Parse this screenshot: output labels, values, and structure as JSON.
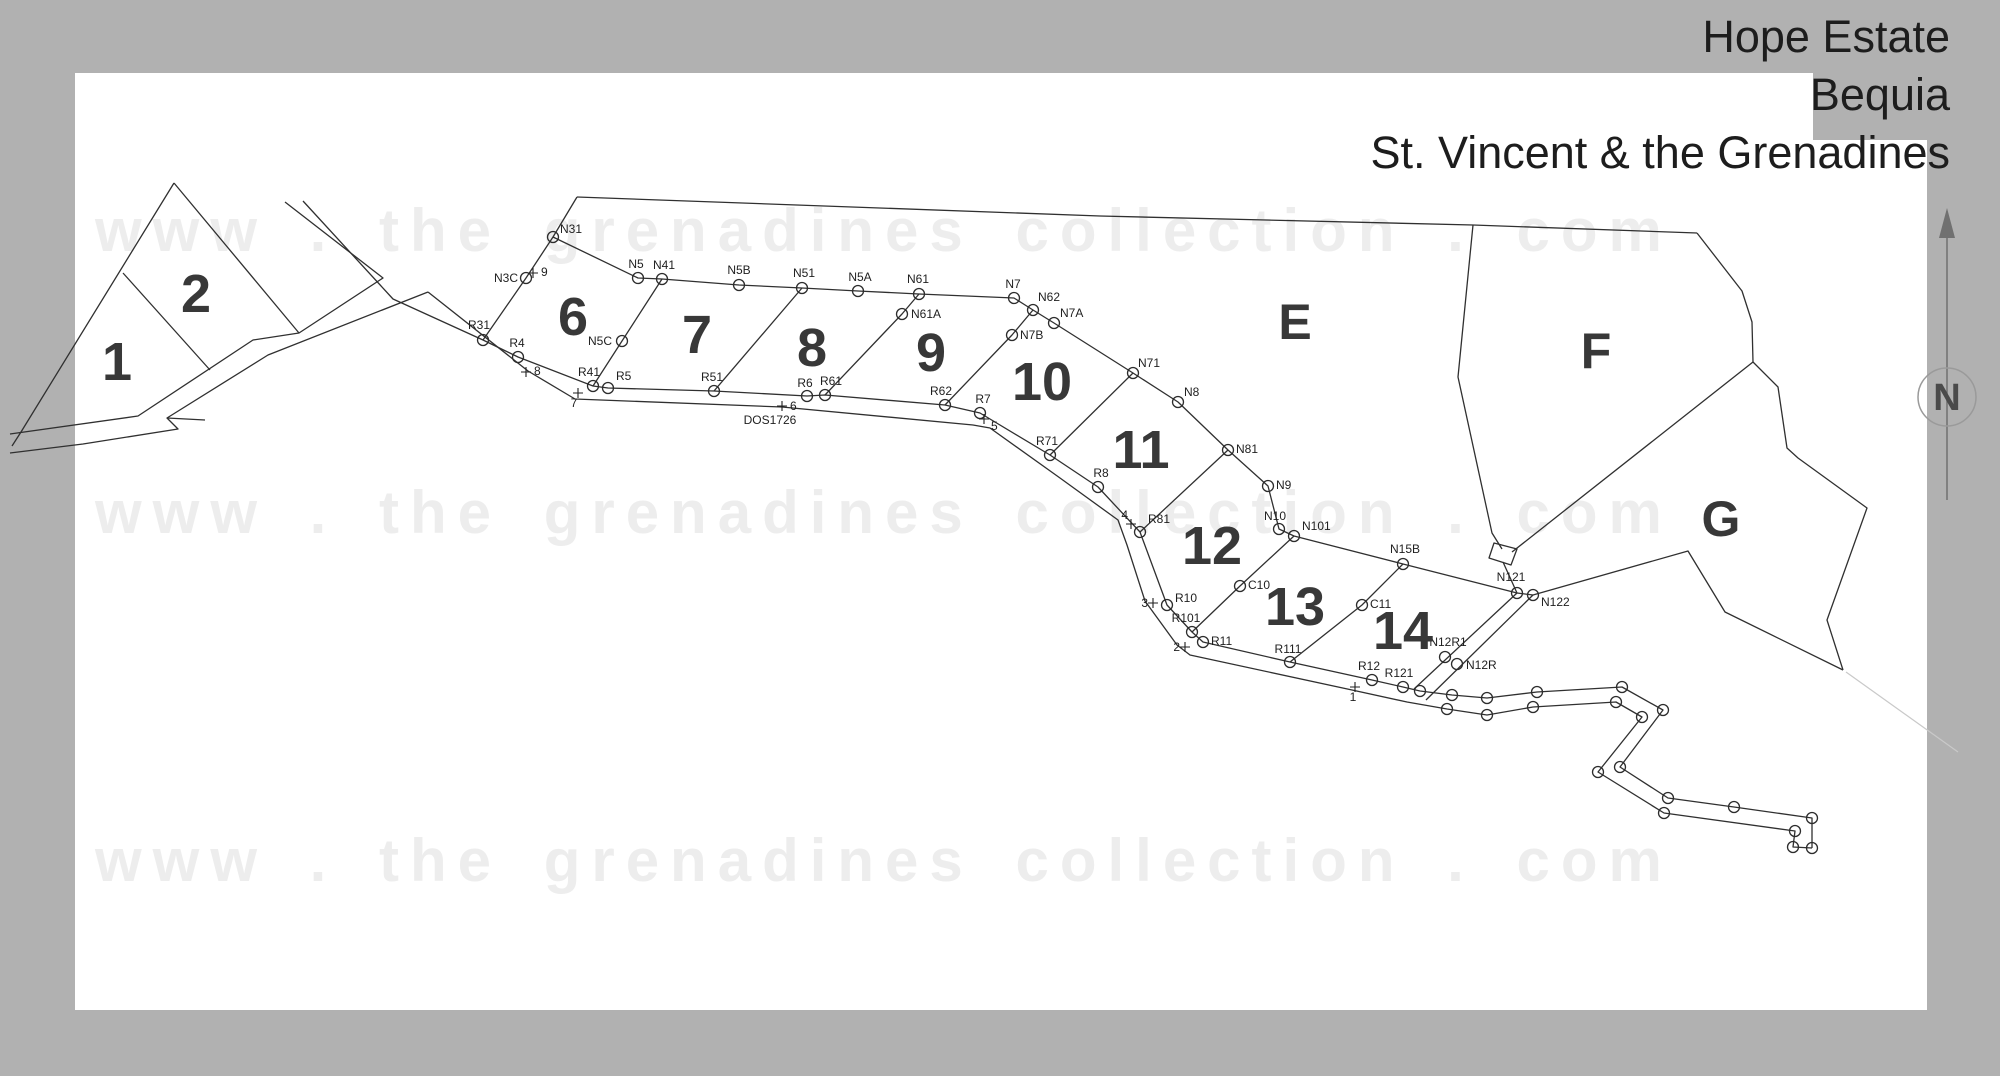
{
  "title": {
    "line1": "Hope Estate",
    "line2": "Bequia",
    "line3": "St. Vincent & the Grenadines"
  },
  "watermark": {
    "text": "www . the grenadines collection . com"
  },
  "north_indicator": {
    "label": "N"
  },
  "colors": {
    "page_margin": "#b1b1b1",
    "map_background": "#ffffff",
    "line": "#303030",
    "watermark": "#ededed",
    "lot_number": "#383838",
    "title_text": "#1d1d1d",
    "north_arrow": "#707070",
    "faint_line": "#c9c9c9"
  },
  "map": {
    "annotations": [
      {
        "text": "DOS1726",
        "x": 770,
        "y": 424,
        "anchor": "middle",
        "size": 13
      }
    ],
    "lot_labels": [
      {
        "text": "1",
        "x": 117,
        "y": 362,
        "size": 54
      },
      {
        "text": "2",
        "x": 196,
        "y": 294,
        "size": 54
      },
      {
        "text": "6",
        "x": 573,
        "y": 317,
        "size": 54
      },
      {
        "text": "7",
        "x": 697,
        "y": 335,
        "size": 54
      },
      {
        "text": "8",
        "x": 812,
        "y": 348,
        "size": 54
      },
      {
        "text": "9",
        "x": 931,
        "y": 353,
        "size": 54
      },
      {
        "text": "10",
        "x": 1042,
        "y": 382,
        "size": 54
      },
      {
        "text": "11",
        "x": 1141,
        "y": 450,
        "size": 54
      },
      {
        "text": "12",
        "x": 1212,
        "y": 546,
        "size": 54
      },
      {
        "text": "13",
        "x": 1295,
        "y": 607,
        "size": 54
      },
      {
        "text": "14",
        "x": 1403,
        "y": 631,
        "size": 54
      }
    ],
    "area_labels": [
      {
        "text": "E",
        "x": 1295,
        "y": 322,
        "size": 50
      },
      {
        "text": "F",
        "x": 1596,
        "y": 351,
        "size": 50
      },
      {
        "text": "G",
        "x": 1721,
        "y": 519,
        "size": 50
      }
    ],
    "survey_points": [
      {
        "label": "N31",
        "x": 553,
        "y": 237,
        "lx": 560,
        "ly": 233,
        "anchor": "start"
      },
      {
        "label": "N3C",
        "x": 526,
        "y": 278,
        "lx": 518,
        "ly": 282,
        "anchor": "end"
      },
      {
        "label": "N5",
        "x": 638,
        "y": 278,
        "lx": 636,
        "ly": 268,
        "anchor": "middle"
      },
      {
        "label": "N41",
        "x": 662,
        "y": 279,
        "lx": 664,
        "ly": 269,
        "anchor": "middle"
      },
      {
        "label": "N5C",
        "x": 622,
        "y": 341,
        "lx": 612,
        "ly": 345,
        "anchor": "end"
      },
      {
        "label": "N5B",
        "x": 739,
        "y": 285,
        "lx": 739,
        "ly": 274,
        "anchor": "middle"
      },
      {
        "label": "N51",
        "x": 802,
        "y": 288,
        "lx": 804,
        "ly": 277,
        "anchor": "middle"
      },
      {
        "label": "N5A",
        "x": 858,
        "y": 291,
        "lx": 860,
        "ly": 281,
        "anchor": "middle"
      },
      {
        "label": "N61",
        "x": 919,
        "y": 294,
        "lx": 918,
        "ly": 283,
        "anchor": "middle"
      },
      {
        "label": "N61A",
        "x": 902,
        "y": 314,
        "lx": 911,
        "ly": 318,
        "anchor": "start"
      },
      {
        "label": "N7",
        "x": 1014,
        "y": 298,
        "lx": 1013,
        "ly": 288,
        "anchor": "middle"
      },
      {
        "label": "N62",
        "x": 1033,
        "y": 310,
        "lx": 1038,
        "ly": 301,
        "anchor": "start"
      },
      {
        "label": "N7A",
        "x": 1054,
        "y": 323,
        "lx": 1060,
        "ly": 317,
        "anchor": "start"
      },
      {
        "label": "N7B",
        "x": 1012,
        "y": 335,
        "lx": 1020,
        "ly": 339,
        "anchor": "start"
      },
      {
        "label": "N71",
        "x": 1133,
        "y": 373,
        "lx": 1138,
        "ly": 367,
        "anchor": "start"
      },
      {
        "label": "N8",
        "x": 1178,
        "y": 402,
        "lx": 1184,
        "ly": 396,
        "anchor": "start"
      },
      {
        "label": "N81",
        "x": 1228,
        "y": 450,
        "lx": 1236,
        "ly": 453,
        "anchor": "start"
      },
      {
        "label": "N9",
        "x": 1268,
        "y": 486,
        "lx": 1276,
        "ly": 489,
        "anchor": "start"
      },
      {
        "label": "N10",
        "x": 1279,
        "y": 529,
        "lx": 1275,
        "ly": 520,
        "anchor": "middle"
      },
      {
        "label": "N101",
        "x": 1294,
        "y": 536,
        "lx": 1302,
        "ly": 530,
        "anchor": "start"
      },
      {
        "label": "N15B",
        "x": 1403,
        "y": 564,
        "lx": 1405,
        "ly": 553,
        "anchor": "middle"
      },
      {
        "label": "N121",
        "x": 1517,
        "y": 593,
        "lx": 1511,
        "ly": 581,
        "anchor": "middle"
      },
      {
        "label": "N122",
        "x": 1533,
        "y": 595,
        "lx": 1541,
        "ly": 606,
        "anchor": "start"
      },
      {
        "label": "N12R1",
        "x": 1445,
        "y": 657,
        "lx": 1448,
        "ly": 646,
        "anchor": "middle"
      },
      {
        "label": "N12R",
        "x": 1457,
        "y": 664,
        "lx": 1466,
        "ly": 669,
        "anchor": "start"
      },
      {
        "label": "C10",
        "x": 1240,
        "y": 586,
        "lx": 1248,
        "ly": 589,
        "anchor": "start"
      },
      {
        "label": "C11",
        "x": 1362,
        "y": 605,
        "lx": 1370,
        "ly": 608,
        "anchor": "start"
      },
      {
        "label": "R31",
        "x": 483,
        "y": 340,
        "lx": 479,
        "ly": 329,
        "anchor": "middle"
      },
      {
        "label": "R4",
        "x": 518,
        "y": 357,
        "lx": 517,
        "ly": 347,
        "anchor": "middle"
      },
      {
        "label": "R41",
        "x": 593,
        "y": 386,
        "lx": 589,
        "ly": 376,
        "anchor": "middle"
      },
      {
        "label": "R5",
        "x": 608,
        "y": 388,
        "lx": 616,
        "ly": 380,
        "anchor": "start"
      },
      {
        "label": "R51",
        "x": 714,
        "y": 391,
        "lx": 712,
        "ly": 381,
        "anchor": "middle"
      },
      {
        "label": "R6",
        "x": 807,
        "y": 396,
        "lx": 805,
        "ly": 387,
        "anchor": "middle"
      },
      {
        "label": "R61",
        "x": 825,
        "y": 395,
        "lx": 831,
        "ly": 385,
        "anchor": "middle"
      },
      {
        "label": "R62",
        "x": 945,
        "y": 405,
        "lx": 941,
        "ly": 395,
        "anchor": "middle"
      },
      {
        "label": "R7",
        "x": 980,
        "y": 413,
        "lx": 983,
        "ly": 403,
        "anchor": "middle"
      },
      {
        "label": "R71",
        "x": 1050,
        "y": 455,
        "lx": 1047,
        "ly": 445,
        "anchor": "middle"
      },
      {
        "label": "R8",
        "x": 1098,
        "y": 487,
        "lx": 1101,
        "ly": 477,
        "anchor": "middle"
      },
      {
        "label": "R81",
        "x": 1140,
        "y": 532,
        "lx": 1148,
        "ly": 523,
        "anchor": "start"
      },
      {
        "label": "R10",
        "x": 1167,
        "y": 605,
        "lx": 1175,
        "ly": 602,
        "anchor": "start"
      },
      {
        "label": "R101",
        "x": 1192,
        "y": 632,
        "lx": 1186,
        "ly": 622,
        "anchor": "middle"
      },
      {
        "label": "R11",
        "x": 1203,
        "y": 642,
        "lx": 1211,
        "ly": 645,
        "anchor": "start"
      },
      {
        "label": "R111",
        "x": 1290,
        "y": 662,
        "lx": 1288,
        "ly": 653,
        "anchor": "middle"
      },
      {
        "label": "R12",
        "x": 1372,
        "y": 680,
        "lx": 1369,
        "ly": 670,
        "anchor": "middle"
      },
      {
        "label": "R121",
        "x": 1403,
        "y": 687,
        "lx": 1399,
        "ly": 677,
        "anchor": "middle"
      }
    ],
    "road_vertices": [
      {
        "x": 1420,
        "y": 691
      },
      {
        "x": 1452,
        "y": 695
      },
      {
        "x": 1487,
        "y": 698
      },
      {
        "x": 1537,
        "y": 692
      },
      {
        "x": 1622,
        "y": 687
      },
      {
        "x": 1447,
        "y": 709
      },
      {
        "x": 1487,
        "y": 715
      },
      {
        "x": 1533,
        "y": 707
      },
      {
        "x": 1616,
        "y": 702
      },
      {
        "x": 1663,
        "y": 710
      },
      {
        "x": 1642,
        "y": 717
      },
      {
        "x": 1620,
        "y": 767
      },
      {
        "x": 1598,
        "y": 772
      },
      {
        "x": 1668,
        "y": 798
      },
      {
        "x": 1664,
        "y": 813
      },
      {
        "x": 1734,
        "y": 807
      },
      {
        "x": 1812,
        "y": 818
      },
      {
        "x": 1795,
        "y": 831
      },
      {
        "x": 1793,
        "y": 847
      },
      {
        "x": 1812,
        "y": 848
      }
    ],
    "chainage_ticks": [
      {
        "label": "9",
        "x": 533,
        "y": 273,
        "lx": 541,
        "ly": 276,
        "anchor": "start"
      },
      {
        "label": "8",
        "x": 526,
        "y": 372,
        "lx": 534,
        "ly": 375,
        "anchor": "start"
      },
      {
        "label": "7",
        "x": 578,
        "y": 393,
        "lx": 574,
        "ly": 407,
        "anchor": "middle"
      },
      {
        "label": "6",
        "x": 782,
        "y": 406,
        "lx": 790,
        "ly": 410,
        "anchor": "start"
      },
      {
        "label": "5",
        "x": 984,
        "y": 419,
        "lx": 991,
        "ly": 430,
        "anchor": "start"
      },
      {
        "label": "4",
        "x": 1131,
        "y": 524,
        "lx": 1128,
        "ly": 519,
        "anchor": "end"
      },
      {
        "label": "3",
        "x": 1153,
        "y": 603,
        "lx": 1148,
        "ly": 607,
        "anchor": "end"
      },
      {
        "label": "2",
        "x": 1185,
        "y": 647,
        "lx": 1180,
        "ly": 651,
        "anchor": "end"
      },
      {
        "label": "1",
        "x": 1355,
        "y": 687,
        "lx": 1353,
        "ly": 701,
        "anchor": "middle"
      }
    ]
  }
}
